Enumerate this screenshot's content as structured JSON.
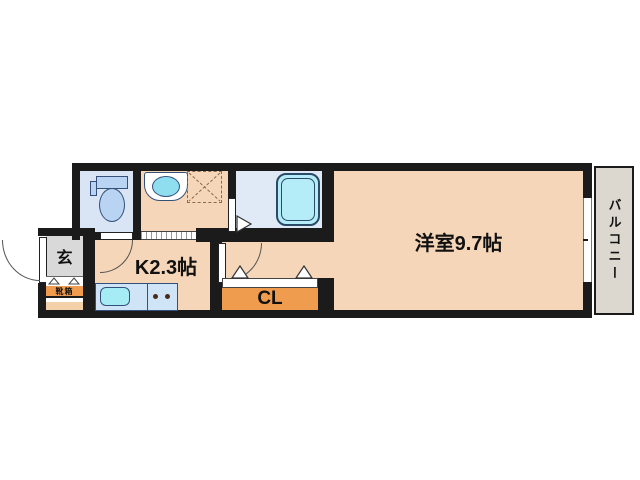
{
  "floorplan": {
    "labels": {
      "entrance": "玄",
      "shoe_box": "靴箱",
      "kitchen": "K2.3帖",
      "closet": "CL",
      "main_room": "洋室9.7帖",
      "balcony": "バルコニー"
    },
    "colors": {
      "wall": "#1b1b1b",
      "room_fill": "#f6d6b8",
      "bath_floor": "#dfeaf6",
      "toilet_floor": "#d9e5f4",
      "closet_fill": "#f09c4e",
      "entrance_fill": "#d9d9d9",
      "balcony_fill": "#dcd7cf",
      "counter_fill": "#cfe5f7",
      "sink_fill": "#a5ecf4",
      "tub_fill": "#b4ecf7",
      "fixture_fill": "#b9d4f2"
    }
  }
}
